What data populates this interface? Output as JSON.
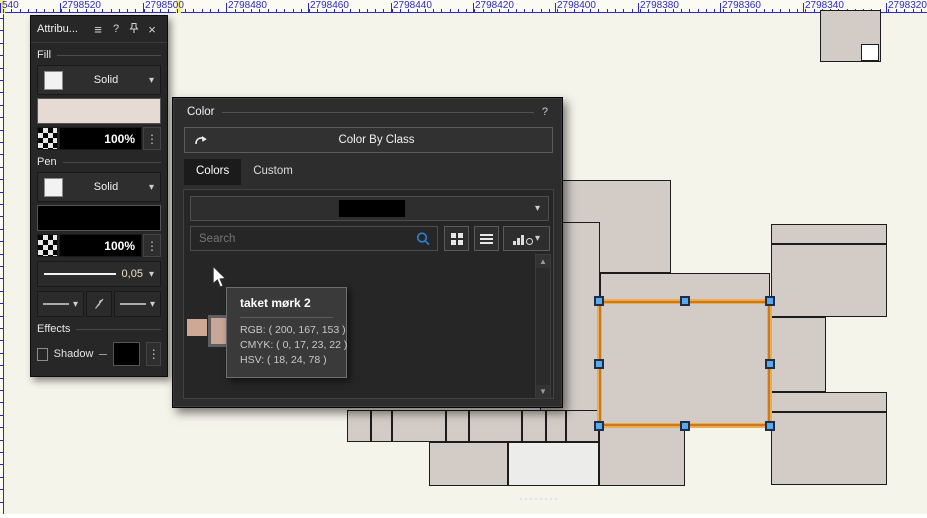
{
  "ruler": {
    "tick_color": "#2a2abf",
    "marker_color": "#f2ee8f",
    "labels": [
      {
        "text": "540",
        "x": 2
      },
      {
        "text": "2798520",
        "x": 62
      },
      {
        "text": "2798500",
        "x": 145
      },
      {
        "text": "2798480",
        "x": 228
      },
      {
        "text": "2798460",
        "x": 310
      },
      {
        "text": "2798440",
        "x": 393
      },
      {
        "text": "2798420",
        "x": 475
      },
      {
        "text": "2798400",
        "x": 557
      },
      {
        "text": "2798380",
        "x": 640
      },
      {
        "text": "2798360",
        "x": 722
      },
      {
        "text": "2798340",
        "x": 805
      },
      {
        "text": "2798320",
        "x": 888
      }
    ],
    "markers": [
      {
        "x": 0,
        "w": 5
      },
      {
        "x": 176,
        "w": 5
      }
    ]
  },
  "icons": {
    "menu": "≡",
    "help": "?",
    "close": "×",
    "chevron": "▾",
    "dots": "⋮",
    "up": "▲",
    "down": "▼"
  },
  "attributes_panel": {
    "title": "Attribu...",
    "fill_section": "Fill",
    "pen_section": "Pen",
    "effects_section": "Effects",
    "fill": {
      "type": "Solid",
      "opacity": "100%",
      "color": "#e5dad4"
    },
    "pen": {
      "type": "Solid",
      "opacity": "100%",
      "color": "#000000",
      "width": "0,05"
    },
    "effects": {
      "shadow_label": "Shadow",
      "shadow_color": "#000000"
    }
  },
  "color_dialog": {
    "title": "Color",
    "help": "?",
    "color_by_class_label": "Color By Class",
    "tabs": [
      {
        "label": "Colors",
        "active": true
      },
      {
        "label": "Custom",
        "active": false
      }
    ],
    "search_placeholder": "Search",
    "palette_name_redacted": "#000000",
    "swatches": [
      {
        "name": "swatch-1",
        "color": "#cfa795",
        "x": 2,
        "y": 65,
        "w": 20,
        "h": 17,
        "hover": false
      },
      {
        "name": "taket mørk 2",
        "color": "#c8a799",
        "x": 23,
        "y": 61,
        "w": 30,
        "h": 32,
        "hover": true
      },
      {
        "name": "swatch-3",
        "color": "#d8bfb2",
        "x": 56,
        "y": 65,
        "w": 20,
        "h": 17,
        "hover": false
      },
      {
        "name": "swatch-4",
        "color": "#f2ede9",
        "x": 77,
        "y": 65,
        "w": 20,
        "h": 17,
        "hover": false
      }
    ],
    "tooltip": {
      "title": "taket mørk 2",
      "rgb": "RGB: ( 200, 167, 153 )",
      "cmyk": "CMYK: ( 0, 17, 23, 22 )",
      "hsv": "HSV: ( 18, 24, 78 )"
    }
  },
  "canvas": {
    "background": "#f5f4ea",
    "building_fill": "#d3ccc6",
    "stroke": "#1c1c1c",
    "buildings": [
      {
        "x": 820,
        "y": 10,
        "w": 61,
        "h": 52
      },
      {
        "x": 861,
        "y": 44,
        "w": 18,
        "h": 17,
        "fill": "#ffffff"
      },
      {
        "x": 490,
        "y": 180,
        "w": 181,
        "h": 93
      },
      {
        "x": 540,
        "y": 222,
        "w": 60,
        "h": 220
      },
      {
        "x": 600,
        "y": 273,
        "w": 170,
        "h": 28
      },
      {
        "x": 599,
        "y": 301,
        "w": 171,
        "h": 125,
        "noborder": true
      },
      {
        "x": 599,
        "y": 426,
        "w": 86,
        "h": 60
      },
      {
        "x": 347,
        "y": 410,
        "w": 24,
        "h": 32
      },
      {
        "x": 371,
        "y": 410,
        "w": 21,
        "h": 32
      },
      {
        "x": 392,
        "y": 410,
        "w": 54,
        "h": 32
      },
      {
        "x": 446,
        "y": 410,
        "w": 23,
        "h": 32
      },
      {
        "x": 469,
        "y": 410,
        "w": 53,
        "h": 32
      },
      {
        "x": 522,
        "y": 410,
        "w": 24,
        "h": 32
      },
      {
        "x": 546,
        "y": 410,
        "w": 20,
        "h": 32
      },
      {
        "x": 566,
        "y": 410,
        "w": 33,
        "h": 32
      },
      {
        "x": 429,
        "y": 442,
        "w": 79,
        "h": 44
      },
      {
        "x": 508,
        "y": 442,
        "w": 91,
        "h": 44,
        "fill": "#ececeb"
      },
      {
        "x": 771,
        "y": 224,
        "w": 116,
        "h": 20
      },
      {
        "x": 771,
        "y": 244,
        "w": 116,
        "h": 73
      },
      {
        "x": 770,
        "y": 317,
        "w": 56,
        "h": 75
      },
      {
        "x": 771,
        "y": 392,
        "w": 116,
        "h": 20
      },
      {
        "x": 771,
        "y": 412,
        "w": 116,
        "h": 73
      }
    ],
    "selection": {
      "x": 599,
      "y": 301,
      "w": 171,
      "h": 125,
      "outline": "#c87a1e",
      "halo": "#efa94e",
      "handle_fill": "#5aa8f0",
      "handle_border": "#1e2e46"
    }
  }
}
